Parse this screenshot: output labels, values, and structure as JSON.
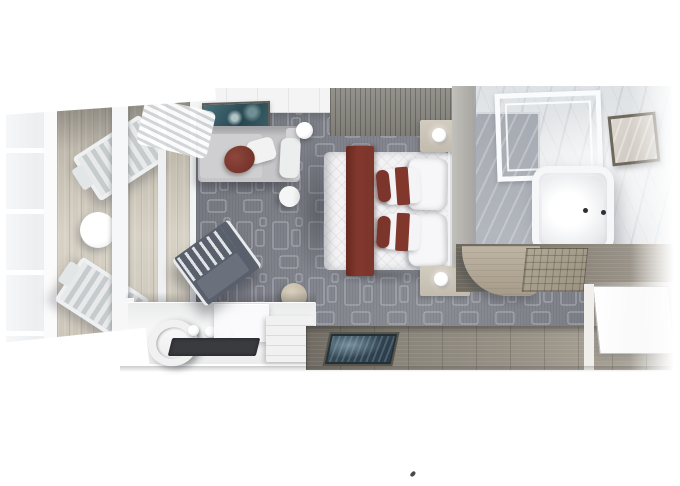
{
  "meta": {
    "type": "3d-rendered-floorplan",
    "description": "Top-down 3D rendering of a cruise-ship balcony suite: private balcony with two loungers and a round table, living area with chaise sofa, wall art, floor lamp and writing desk, bedroom with double bed dressed in white linens and a burgundy runner and pillows, marble bathroom with bathtub, glass shower and mirror, and an entry hallway with wood floor, dark blue mat and open white door.",
    "visible_text": ""
  },
  "palette": {
    "canvas": "#ffffff",
    "carpet": "#83858e",
    "carpet-pattern-line": "#c9ccd4",
    "balcony-wood": "#cdc7ba",
    "balcony-wood-dark": "#a9a399",
    "entry-wood": "#8a857b",
    "wall-wood-dark": "#7f7d76",
    "wall-wood-grey": "#a3a29e",
    "marble-light": "#e9ebed",
    "marble-grey": "#a6aab2",
    "sofa-grey": "#c6c6c8",
    "accent-maroon": "#82372c",
    "bed-white": "#f3f3f5",
    "chair-slate": "#59606c",
    "rug-teal": "#3a4d5a",
    "pouf-beige": "#b3a995",
    "art-teal": "#3a5f68"
  },
  "areas": {
    "balcony": "balcony",
    "living": "living-area",
    "bedroom": "bedroom",
    "bathroom": "bathroom",
    "entry": "entry-hallway"
  },
  "furniture": [
    "lounge-chair-upper",
    "lounge-chair-lower",
    "balcony-round-table",
    "glass-door-wall",
    "curtain",
    "chaise-sofa",
    "maroon-cushion",
    "white-cushion",
    "wall-art",
    "floor-lamp",
    "white-side-stool",
    "beige-pouf",
    "writing-desk",
    "desk-lamp",
    "desk-knobs",
    "frosted-cabinet",
    "dark-desk-mat",
    "drawer-unit",
    "slatted-desk-chair",
    "double-bed",
    "burgundy-bed-runner",
    "white-pillows",
    "burgundy-sash-pillows",
    "headboard",
    "nightstand-upper",
    "nightstand-lower",
    "bedside-lamp-upper",
    "bedside-lamp-lower",
    "divider-wall",
    "curved-wood-cabinet",
    "shower-floor",
    "glass-shower-frame",
    "bathtub",
    "tub-faucet-dots",
    "framed-mirror",
    "teak-bath-mat",
    "entry-rug",
    "entry-door",
    "stray-mark"
  ]
}
